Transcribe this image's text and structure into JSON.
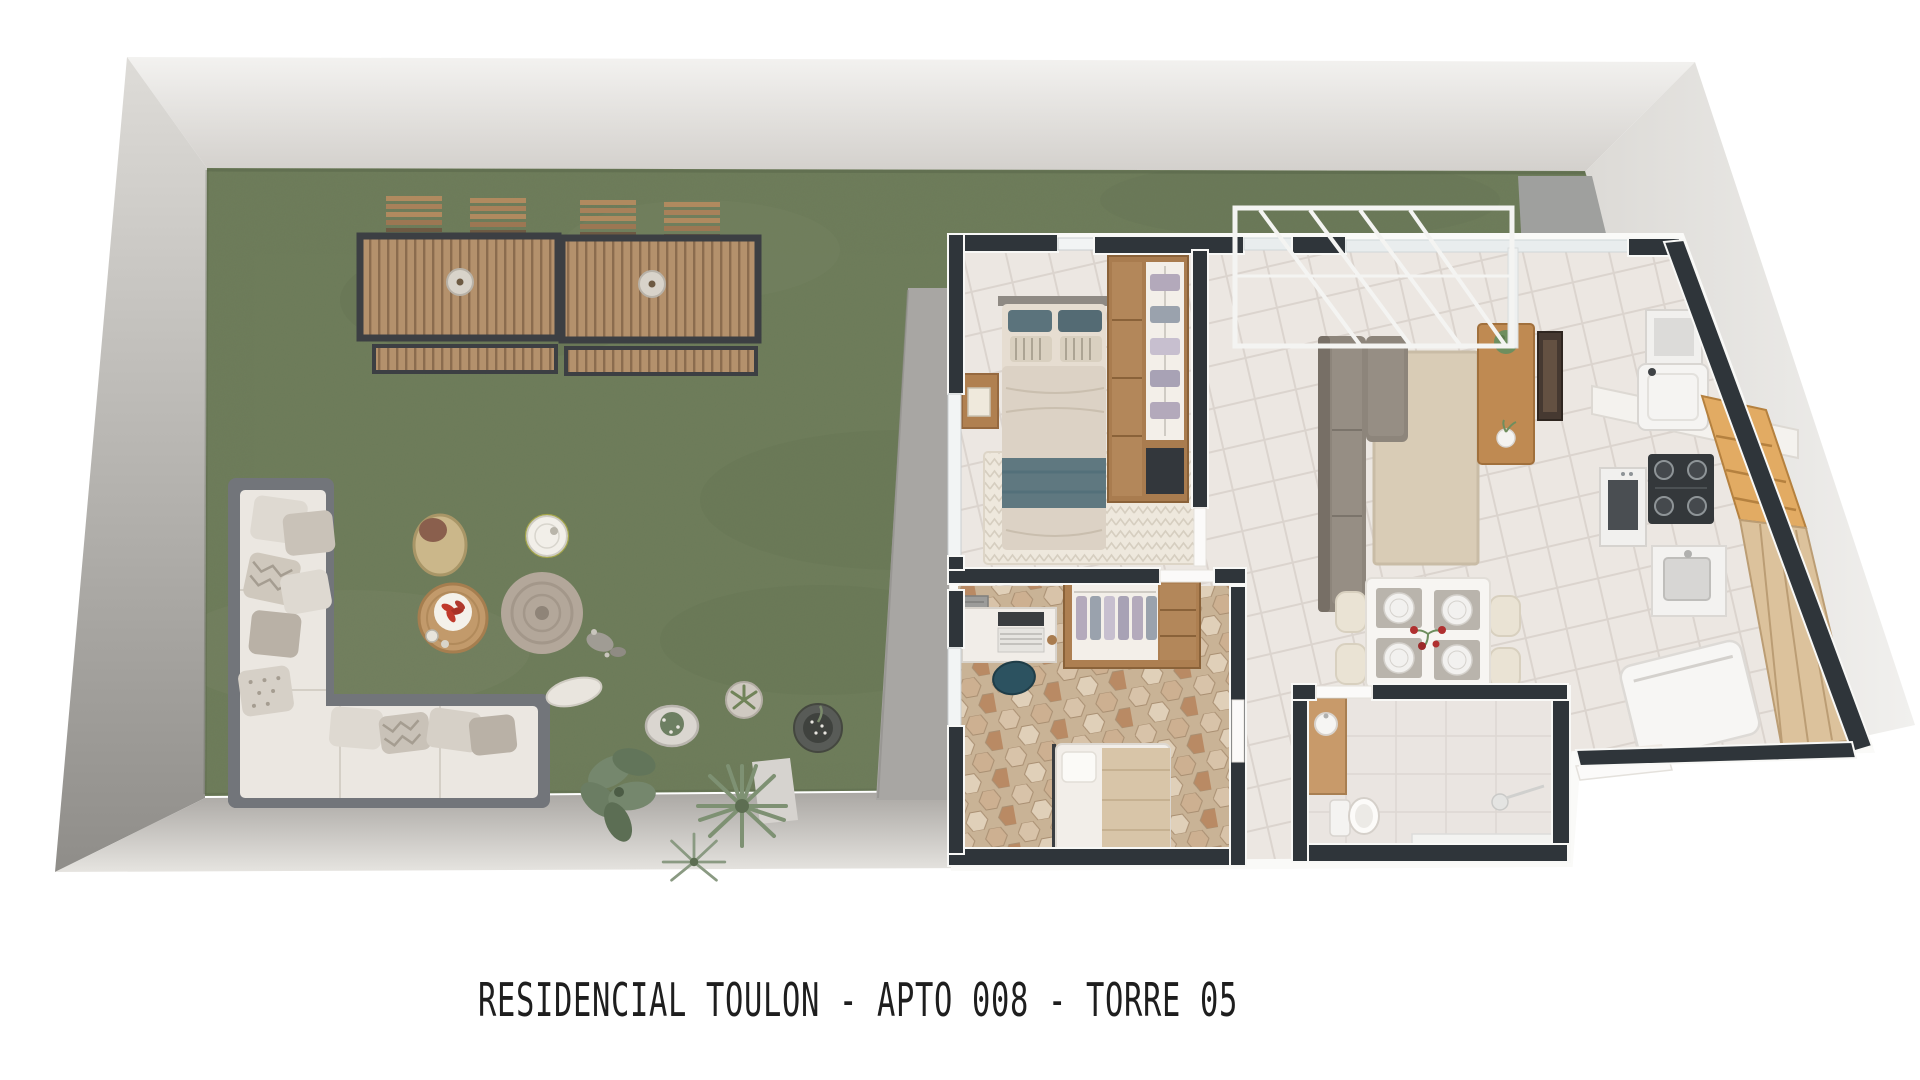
{
  "caption": {
    "text": "RESIDENCIAL TOULON - APTO 008 - TORRE 05"
  },
  "palette": {
    "background": "#ffffff",
    "grass": "#6f7d5b",
    "perimeter_wall_light": "#eeedeb",
    "perimeter_wall_shadow": "#94928e",
    "concrete_path": "#a8a6a3",
    "apartment_wall": "#2f353a",
    "wall_trim": "#f8f8f6",
    "floor_tile": "#ece7e2",
    "hex_tile": "#d0b596",
    "wood": "#b08254",
    "wood_light": "#dfc096",
    "sofa_taupe": "#8d857b",
    "garden_sofa_frame": "#72757a",
    "cushion_white": "#ebe7e1",
    "accent_teal": "#5b737c",
    "living_rug": "#d9ccb6",
    "caption_color": "#1e1e1e"
  },
  "regions": [
    "garden",
    "pergola-decks",
    "garden-sofa",
    "apartment",
    "bedroom-1",
    "bedroom-2",
    "living-room",
    "dining-area",
    "kitchen",
    "laundry",
    "bathroom"
  ]
}
